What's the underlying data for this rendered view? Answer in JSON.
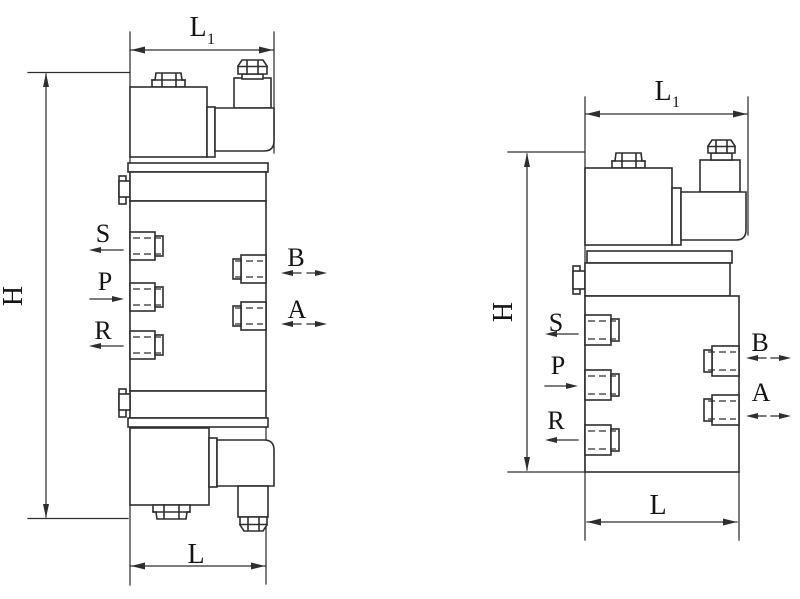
{
  "page": {
    "background": "#ffffff"
  },
  "figure": {
    "line_color": "#2e2e2e",
    "views": [
      {
        "name": "valve side view with two solenoids",
        "dims": {
          "top_main": "L",
          "top_sub": "1",
          "height": "H",
          "bottom": "L"
        },
        "ports_left": [
          {
            "label": "S",
            "arrow": "left"
          },
          {
            "label": "P",
            "arrow": "right"
          },
          {
            "label": "R",
            "arrow": "left"
          }
        ],
        "ports_right": [
          {
            "label": "B",
            "arrow": "both"
          },
          {
            "label": "A",
            "arrow": "both"
          }
        ]
      },
      {
        "name": "valve side view with single solenoid",
        "dims": {
          "top_main": "L",
          "top_sub": "1",
          "height": "H",
          "bottom": "L"
        },
        "ports_left": [
          {
            "label": "S",
            "arrow": "left"
          },
          {
            "label": "P",
            "arrow": "right"
          },
          {
            "label": "R",
            "arrow": "left"
          }
        ],
        "ports_right": [
          {
            "label": "B",
            "arrow": "both"
          },
          {
            "label": "A",
            "arrow": "both"
          }
        ]
      }
    ]
  }
}
